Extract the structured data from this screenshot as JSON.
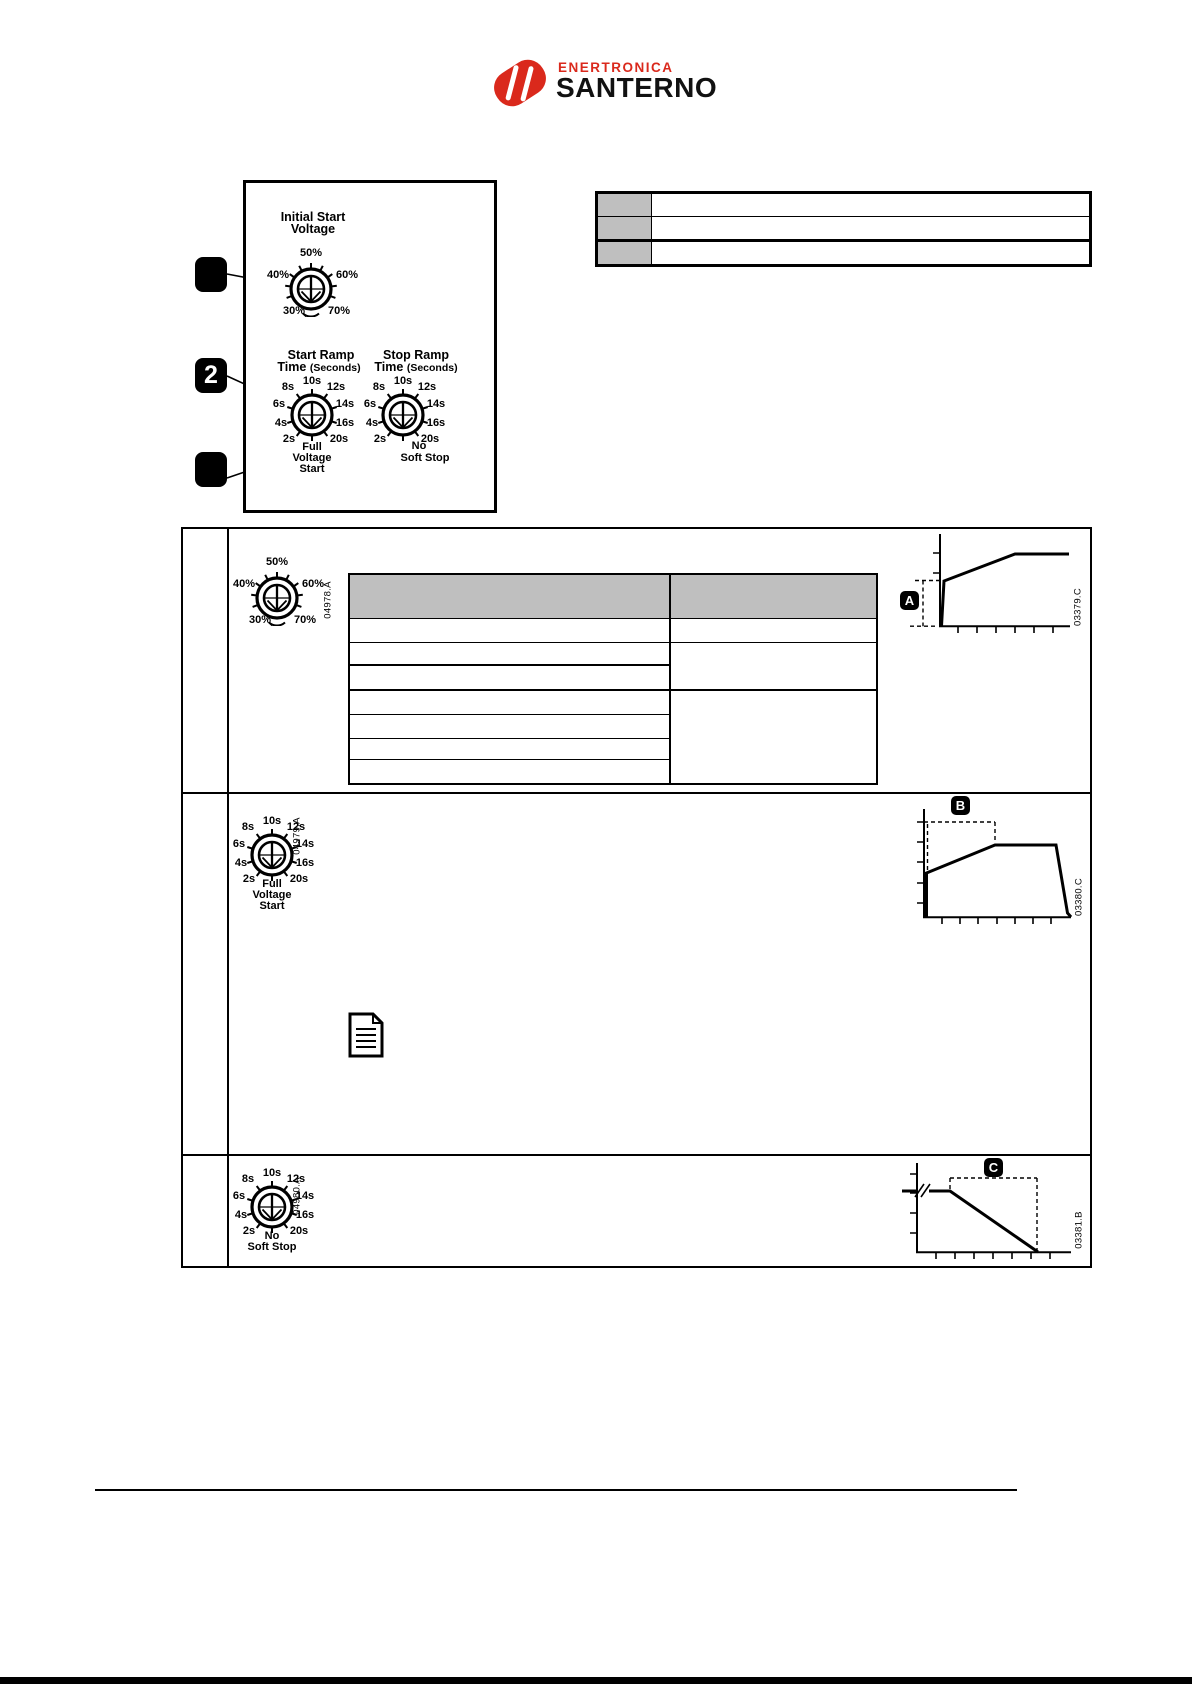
{
  "logo": {
    "enertronica": "ENERTRONICA",
    "santerno": "SANTERNO",
    "red": "#da291c"
  },
  "panel": {
    "initial_start_voltage": {
      "title": [
        "Initial Start",
        "Voltage"
      ],
      "ticks": [
        "50%",
        "40%",
        "60%",
        "30%",
        "70%"
      ]
    },
    "start_ramp": {
      "title": [
        "Start Ramp",
        "Time",
        "(Seconds)"
      ],
      "ticks": [
        "10s",
        "8s",
        "12s",
        "6s",
        "14s",
        "4s",
        "16s",
        "2s",
        "20s"
      ],
      "caption": [
        "Full",
        "Voltage",
        "Start"
      ]
    },
    "stop_ramp": {
      "title": [
        "Stop Ramp",
        "Time",
        "(Seconds)"
      ],
      "ticks": [
        "10s",
        "8s",
        "12s",
        "6s",
        "14s",
        "4s",
        "16s",
        "2s",
        "20s"
      ],
      "caption": [
        "No",
        "Soft Stop"
      ]
    },
    "callout2": "2"
  },
  "rows": {
    "initial_voltage": {
      "ticks": [
        "50%",
        "40%",
        "60%",
        "30%",
        "70%"
      ],
      "image_id": "04978.A",
      "badge": "A",
      "figure_id": "03379.C"
    },
    "start_ramp": {
      "ticks": [
        "10s",
        "8s",
        "12s",
        "6s",
        "14s",
        "4s",
        "16s",
        "2s",
        "20s"
      ],
      "caption": [
        "Full",
        "Voltage",
        "Start"
      ],
      "image_id": "04979.A",
      "badge": "B",
      "figure_id": "03380.C"
    },
    "stop_ramp": {
      "ticks": [
        "10s",
        "8s",
        "12s",
        "6s",
        "14s",
        "4s",
        "16s",
        "2s",
        "20s"
      ],
      "caption": [
        "No",
        "Soft Stop"
      ],
      "image_id": "04980.A",
      "badge": "C",
      "figure_id": "03381.B"
    }
  },
  "colors": {
    "table_header_gray": "#bfbfbf"
  }
}
